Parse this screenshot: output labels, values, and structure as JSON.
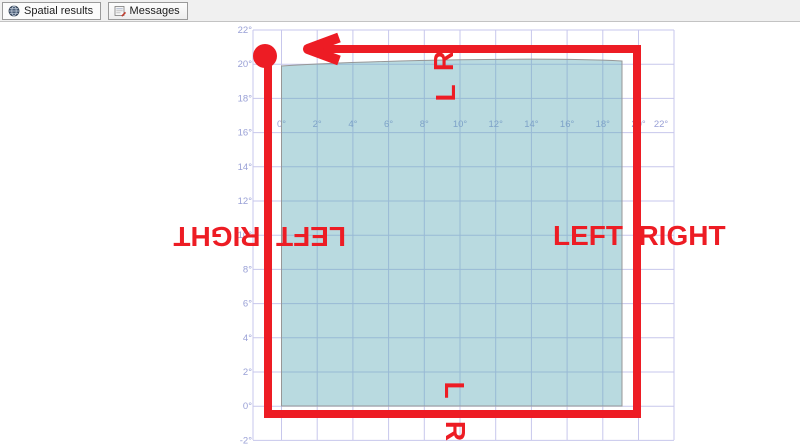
{
  "tab_bar": {
    "tabs": [
      {
        "label": "Spatial results",
        "icon": "globe-icon",
        "active": true
      },
      {
        "label": "Messages",
        "icon": "messages-icon",
        "active": false
      }
    ]
  },
  "chart_data": {
    "type": "area",
    "description": "Spatial results grid showing one filled square polygon spanning about 0-20 degrees in both axes, with red overlay annotations marking the ring path, its start point, travel direction (arrow pointing left along top edge) and LEFT/RIGHT side labels.",
    "x_tick_labels": [
      "0°",
      "2°",
      "4°",
      "6°",
      "8°",
      "10°",
      "12°",
      "14°",
      "16°",
      "18°",
      "20°",
      "22°"
    ],
    "y_tick_labels": [
      "22°",
      "20°",
      "18°",
      "16°",
      "14°",
      "12°",
      "10°",
      "8°",
      "6°",
      "4°",
      "2°",
      "0°",
      "-2°"
    ],
    "x_range_deg": [
      -2,
      22
    ],
    "y_range_deg": [
      -2,
      22
    ],
    "grid": true,
    "grid_color": "#c7c7ec",
    "tick_label_color": "#99a0d6",
    "polygon": {
      "shape": "square region",
      "x_extent_deg": [
        0,
        20
      ],
      "y_extent_deg": [
        0,
        20
      ],
      "fill": "#58a8b4",
      "fill_opacity": "0.42",
      "border_color": "#979797"
    }
  },
  "annotations": {
    "color": "#ed1c24",
    "start_marker": "red-circle at top-left corner of ring",
    "arrow_direction": "left along top edge",
    "top_edge": {
      "outer_letter": "R",
      "inner_letter": "L",
      "rotation_deg": -90
    },
    "bottom_edge": {
      "inner_letter": "L",
      "outer_letter": "R",
      "rotation_deg": 90
    },
    "left_edge": {
      "outer_word": "RIGHT",
      "inner_word": "LEFT",
      "rotation_deg": 180
    },
    "right_edge": {
      "inner_word": "LEFT",
      "outer_word": "RIGHT",
      "rotation_deg": 0
    }
  }
}
